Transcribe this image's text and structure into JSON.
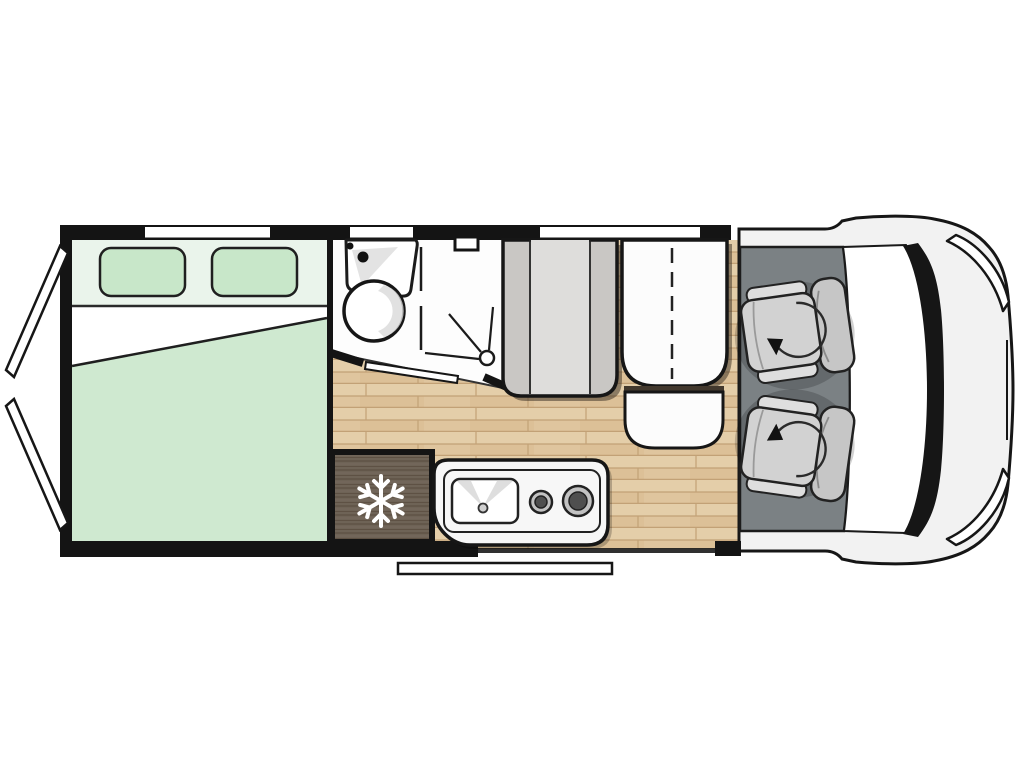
{
  "floorplan": {
    "vehicle_type": "motorhome",
    "view": "top-down floor plan",
    "front_direction": "right",
    "rooms": {
      "rear_bedroom": {
        "bed": "transverse double bed",
        "pillows": 2
      },
      "bathroom": {
        "washbasin": true,
        "round_basin": true,
        "shower": true,
        "roof_vent": true,
        "sliding_door": true
      },
      "kitchen": {
        "refrigerator": true,
        "hob_burners": 2,
        "sink": true
      },
      "lounge": {
        "bench_seat": true,
        "folding_table": true,
        "side_bench": true
      },
      "cab": {
        "swivel_seats": 2
      }
    },
    "windows_count": 3,
    "rear_doors_count": 2,
    "entry_step": true
  },
  "icons": {
    "snowflake": {
      "name": "snowflake-icon",
      "meaning": "refrigerator"
    },
    "swivel_arrow": {
      "name": "swivel-arrow-icon",
      "meaning": "rotating cab seat"
    },
    "shower_head": {
      "name": "shower-head-icon",
      "meaning": "shower"
    }
  },
  "colors": {
    "wall": "#141414",
    "bed_green": "#cfe9d0",
    "bed_head": "#eaf4eb",
    "pillow_green": "#c8e7c9",
    "sheet_white": "#ffffff",
    "wood_base": "#dfc59e",
    "wood_line": "#c2a176",
    "wood_light": "#ecdab6",
    "wood_mid": "#d6b88c",
    "fridge_wood": "#6e6356",
    "fridge_grain": "#584b3e",
    "fridge_grain_light": "#7c7063",
    "snowflake_white": "#ffffff",
    "bath_floor": "#fdfdfd",
    "bench_gray": "#c9c7c4",
    "bench_light": "#dedddb",
    "table_white": "#fcfcfc",
    "counter_white": "#f7f7f7",
    "burner_ring": "#c2c2c2",
    "burner_center": "#4f4f4f",
    "cab_floor": "#7b8184",
    "seat_gray": "#d2d2d2",
    "seat_light": "#dedede",
    "seat_dark": "#c6c6c6",
    "body_white": "#f2f2f2",
    "glass_black": "#161616",
    "white": "#ffffff"
  }
}
